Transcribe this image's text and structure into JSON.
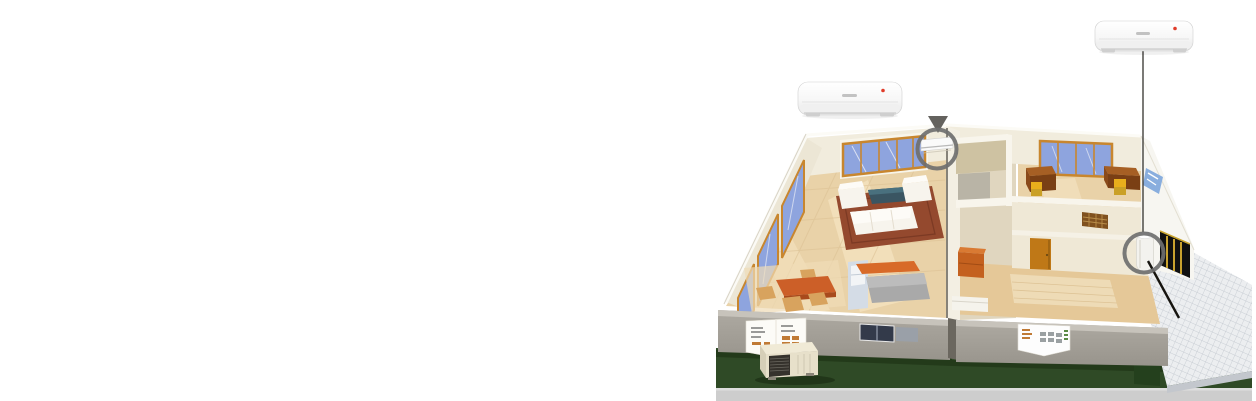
{
  "canvas": {
    "width": 1256,
    "height": 401,
    "background": "#ffffff"
  },
  "colors": {
    "wall_cream": "#f1ecdd",
    "wall_cream_dark": "#e7e0ce",
    "wall_top_white": "#f8f5ec",
    "wall_gray": "#a6a29a",
    "wall_gray_top": "#c7c3bb",
    "floor_wood": "#e9d2a8",
    "floor_wood_light": "#f6e6c6",
    "floor_front": "#e5c898",
    "rug": "#94492e",
    "glass": "#8ea4de",
    "window_frame": "#c8862e",
    "lawn": "#2f4a26",
    "lawn_shadow": "#203517",
    "hedge": "#24401d",
    "patio": "#eceef0",
    "patio_grid": "#b9bfc8",
    "ring": "#6f6f6f",
    "leader_line": "#43413d",
    "pipe_line": "#16140f",
    "ac_body": "#fdfdfd",
    "ac_lip": "#f0f0f0",
    "accent_red": "#e03c2a",
    "logo_gray": "#c2c2c2",
    "desk_brown": "#8a4a1a",
    "desk_brown_top": "#a65f24",
    "chair_yellow": "#e8ae1c",
    "door_orange": "#bf7817",
    "table_orange": "#cc5f28",
    "dining_chair": "#d8a35e",
    "counter_orange": "#d86a28",
    "island_gray": "#a9a9a9",
    "kitchen_cabinet": "#d4dce6",
    "sofa_white": "#f7f4ed",
    "coffee_table": "#3a5562",
    "outdoor_unit_body": "#e7e0ca",
    "outdoor_unit_grille": "#35322c",
    "doorway_dark": "#101010",
    "doorway_frame_yellow": "#c9a22e",
    "decal_blue": "#89aede",
    "bottom_strip": "#cdcdcd"
  },
  "products": {
    "left_ac": {
      "icon": "split-ac-indoor-unit",
      "brand_mark": "gree-logo",
      "status_dot": "power-indicator-dot"
    },
    "right_ac": {
      "icon": "split-ac-indoor-unit",
      "brand_mark": "gree-logo",
      "status_dot": "power-indicator-dot"
    }
  },
  "callouts": {
    "left": {
      "target_icon": "wall-mounted-indoor-unit",
      "marker": "highlight-circle"
    },
    "right": {
      "target_icon": "floor-standing-indoor-unit",
      "marker": "highlight-circle"
    }
  }
}
